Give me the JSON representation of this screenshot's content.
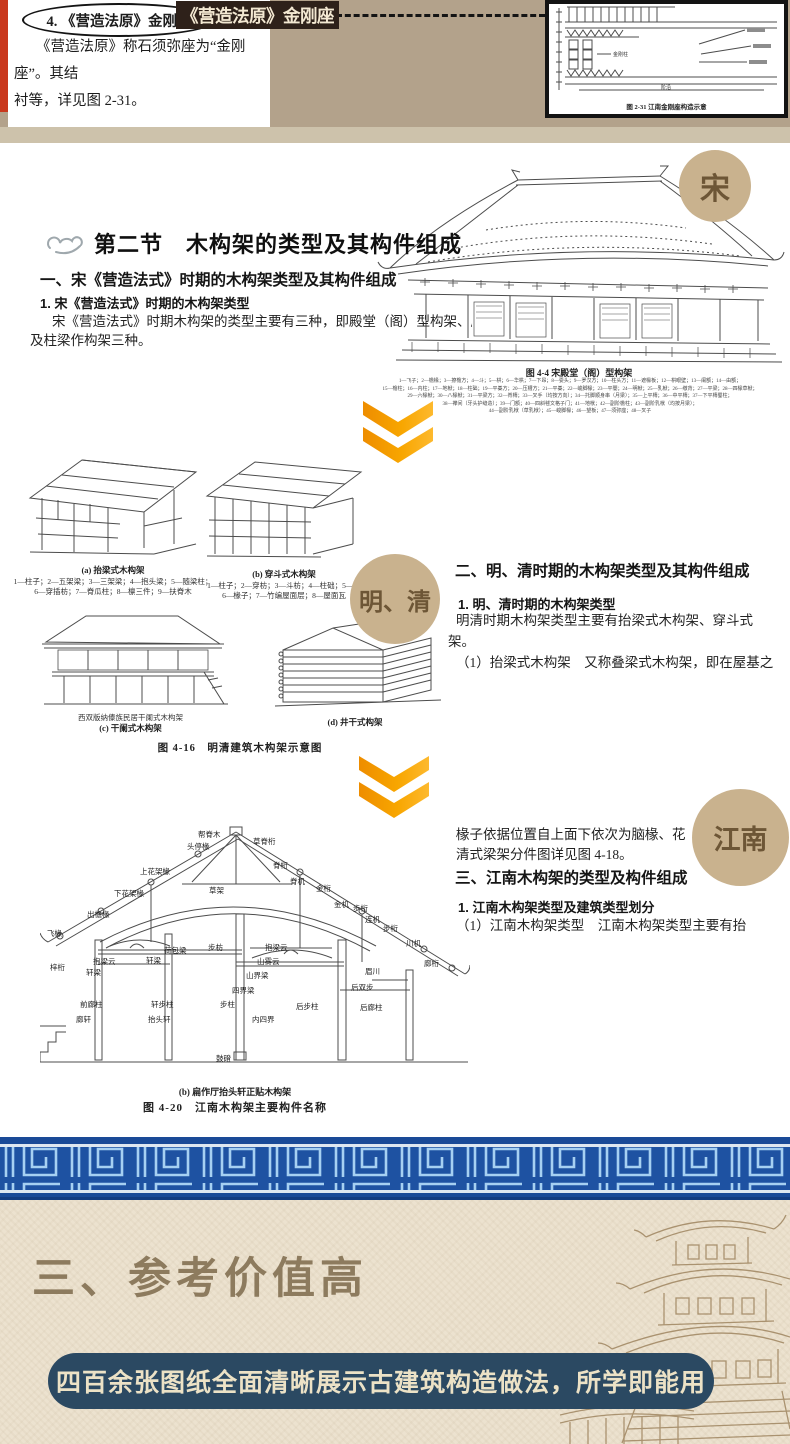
{
  "colors": {
    "page_tan": "#b3a28b",
    "red_strip": "#c9381d",
    "badge_dark_bg": "#2e211a",
    "badge_dark_text": "#f3e8d2",
    "dynasty_badge_bg": "#c9b28e",
    "dynasty_badge_text": "#6d5636",
    "chevron_orange": "#f7a200",
    "divider_blue": "#1e52a2",
    "divider_line": "#a6d0f2",
    "bottom_beige": "#ece2cf",
    "banner_navy": "#2b4962",
    "banner_text": "#ece2c6",
    "bottom_title": "#8d7b5e"
  },
  "top_note": {
    "item_label": "4. 《营造法原》金刚座",
    "body_line1": "《营造法原》称石须弥座为“金刚座”。其结",
    "body_line2": "衬等，详见图 2-31。",
    "badge": "《营造法原》金刚座",
    "figure_label_jingangzhu": "金刚柱",
    "figure_label_jieyan": "阶沿",
    "figure_caption": "图 2-31  江南金刚座构造示意"
  },
  "song": {
    "badge": "宋",
    "header_label": "第二节",
    "header_title": "木构架的类型及其构件组成",
    "h1": "一、宋《营造法式》时期的木构架类型及其构件组成",
    "h2": "1. 宋《营造法式》时期的木构架类型",
    "p_line1": "宋《营造法式》时期木构架的类型主要有三种，即殿堂（阁）型构架、厅堂（阁）",
    "p_line2": "及柱梁作构架三种。",
    "fig44": {
      "caption": "图 4-4  宋殿堂（阁）型构架",
      "lines": [
        "1—飞子；2—檐椽；3—撩檐方；4—斗；5—栱；6—华栱；7—下昂；8—耍头；9—罗汉方；10—柱头方；11—遮椽板；12—栱眼壁；13—阑额；14—由额；",
        "15—檐柱；16—内柱；17—地栿；18—柱础；19—平棊方；20—压槽方；21—平棊；22—峻脚椽；23—平闇；24—明栿；25—乳栿；26—缴背；27—平梁；28—四椽草栿；",
        "29—六椽栿；30—八椽栿；31—平梁方；32—脊槫；33—叉手（均按方向）；34—托脚顺身串（月梁）；35—上平槫；36—中平槫；37—下平槫蜀柱；",
        "38—襻间（牙头护缝造）；39—门额；40—四斜毬文格子门；41—地栿；42—副阶檐柱；43—副阶乳栿（均按月梁）；",
        "44—副阶乳栿（草乳栿）；45—峻脚椽；46—望板；47—须弥座；48—叉子"
      ]
    }
  },
  "mingqing": {
    "badge": "明、清",
    "h1": "二、明、清时期的木构架类型及其构件组成",
    "h2": "1. 明、清时期的木构架类型",
    "p_line1": "明清时期木构架类型主要有抬梁式木构架、穿斗式",
    "p_line2": "架。",
    "p_line3": "（1）抬梁式木构架　又称叠梁式木构架，即在屋基之",
    "fig_a_caption": "(a) 抬梁式木构架",
    "fig_a_labels": [
      "1—柱子；2—五架梁；3—三架梁；4—抱头梁；5—随梁柱；",
      "6—穿插枋；7—脊瓜柱；8—檩三件；9—扶脊木"
    ],
    "fig_b_caption": "(b) 穿斗式木构架",
    "fig_b_labels": [
      "1—柱子；2—穿枋；3—斗枋；4—柱础；5—檩",
      "6—椽子；7—竹编屋面层；8—屋面瓦"
    ],
    "fig_c_note": "西双版纳傣族民居干阑式木构架",
    "fig_c_caption": "(c) 干阑式木构架",
    "fig_d_caption": "(d) 井干式构架",
    "fig416_caption": "图 4-16　明清建筑木构架示意图"
  },
  "jiangnan": {
    "badge": "江南",
    "p0_line1": "椽子依据位置自上面下依次为脑椽、花",
    "p0_line2": "清式梁架分件图详见图 4-18。",
    "h1": "三、江南木构架的类型及构件组成",
    "h2": "1. 江南木构架类型及建筑类型划分",
    "p_line1": "（1）江南木构架类型　江南木构架类型主要有抬",
    "fig420_sub_caption": "(b) 扁作厅抬头轩正贴木构架",
    "fig420_caption": "图 4-20　江南木构架主要构件名称",
    "cross_labels": [
      {
        "t": "帮脊木",
        "x": 158,
        "y": 7
      },
      {
        "t": "头停椽",
        "x": 147,
        "y": 19
      },
      {
        "t": "草脊桁",
        "x": 213,
        "y": 14
      },
      {
        "t": "脊桁",
        "x": 233,
        "y": 38
      },
      {
        "t": "上花架椽",
        "x": 100,
        "y": 44
      },
      {
        "t": "脊机",
        "x": 250,
        "y": 54
      },
      {
        "t": "草架",
        "x": 169,
        "y": 63
      },
      {
        "t": "金桁",
        "x": 276,
        "y": 61
      },
      {
        "t": "下花架椽",
        "x": 74,
        "y": 66
      },
      {
        "t": "金机",
        "x": 294,
        "y": 77
      },
      {
        "t": "步桁",
        "x": 313,
        "y": 81
      },
      {
        "t": "出檐椽",
        "x": 47,
        "y": 87
      },
      {
        "t": "连机",
        "x": 325,
        "y": 92
      },
      {
        "t": "步桁",
        "x": 343,
        "y": 101
      },
      {
        "t": "飞椽",
        "x": 7,
        "y": 106
      },
      {
        "t": "川机",
        "x": 366,
        "y": 116
      },
      {
        "t": "步枋",
        "x": 168,
        "y": 120
      },
      {
        "t": "荷包梁",
        "x": 124,
        "y": 123
      },
      {
        "t": "抱梁云",
        "x": 225,
        "y": 120
      },
      {
        "t": "轩梁",
        "x": 106,
        "y": 133
      },
      {
        "t": "山雾云",
        "x": 217,
        "y": 134
      },
      {
        "t": "抱梁云",
        "x": 53,
        "y": 134
      },
      {
        "t": "梓桁",
        "x": 10,
        "y": 140
      },
      {
        "t": "轩梁",
        "x": 46,
        "y": 145
      },
      {
        "t": "山界梁",
        "x": 206,
        "y": 148
      },
      {
        "t": "眉川",
        "x": 325,
        "y": 144
      },
      {
        "t": "廊桁",
        "x": 384,
        "y": 136
      },
      {
        "t": "后双步",
        "x": 311,
        "y": 160
      },
      {
        "t": "四界梁",
        "x": 192,
        "y": 163
      },
      {
        "t": "前廊柱",
        "x": 40,
        "y": 177
      },
      {
        "t": "轩步柱",
        "x": 111,
        "y": 177
      },
      {
        "t": "步柱",
        "x": 180,
        "y": 177
      },
      {
        "t": "后步柱",
        "x": 256,
        "y": 179
      },
      {
        "t": "后廊柱",
        "x": 320,
        "y": 180
      },
      {
        "t": "廊轩",
        "x": 36,
        "y": 192
      },
      {
        "t": "抬头轩",
        "x": 108,
        "y": 192
      },
      {
        "t": "内四界",
        "x": 212,
        "y": 192
      },
      {
        "t": "鼓磴",
        "x": 176,
        "y": 231
      }
    ]
  },
  "bottom": {
    "title": "三、参考价值高",
    "banner": "四百余张图纸全面清晰展示古建筑构造做法，所学即能用"
  }
}
